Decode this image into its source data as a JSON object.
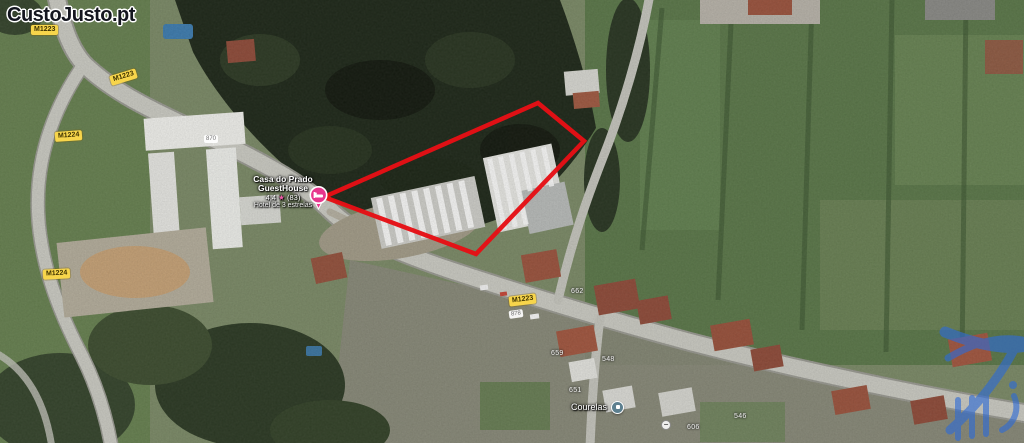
{
  "logo": {
    "text": "CustoJusto.pt"
  },
  "badges": [
    {
      "label": "M1223"
    },
    {
      "label": "M1223"
    },
    {
      "label": "M1224"
    },
    {
      "label": "M1224"
    },
    {
      "label": "M1223"
    }
  ],
  "shields": [
    {
      "label": "870"
    },
    {
      "label": "878"
    }
  ],
  "house_numbers": [
    {
      "label": "662"
    },
    {
      "label": "659"
    },
    {
      "label": "651"
    },
    {
      "label": "548"
    },
    {
      "label": "606"
    },
    {
      "label": "546"
    }
  ],
  "place": {
    "line1": "Casa do Prado",
    "line2": "GuestHouse",
    "rating": "4,4",
    "star": "★",
    "reviews": "(83)",
    "category": "Hotel de 3 estrelas"
  },
  "locality": {
    "name": "Courelas"
  },
  "icons": {
    "restriction": "−"
  },
  "colors": {
    "boundary_red": "#e50f15",
    "badge_yellow": "#f7d54b",
    "hotel_pin_pink": "#e7368d",
    "locality_pin_teal": "#5c7f8f",
    "watermark_blue": "#2e6bd6"
  }
}
